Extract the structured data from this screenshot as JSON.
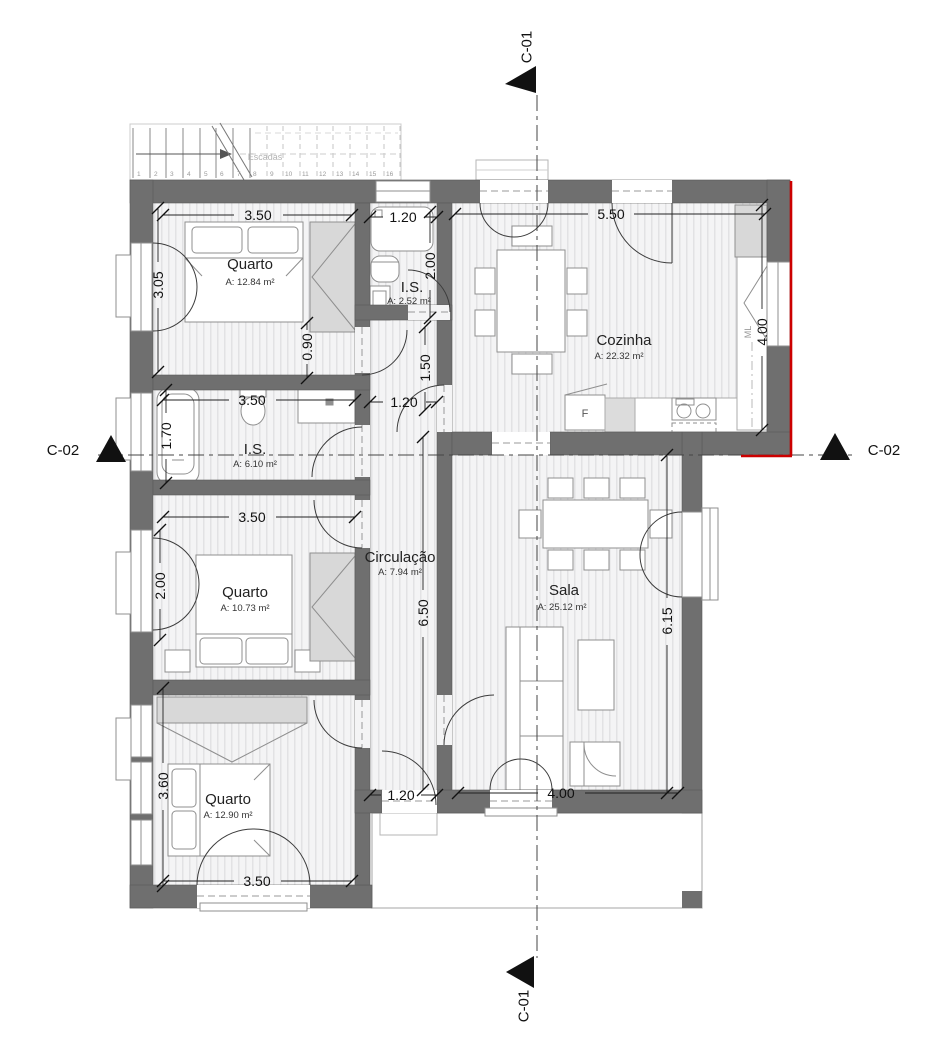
{
  "rooms": {
    "quarto1": {
      "name": "Quarto",
      "area": "A: 12.84 m²"
    },
    "is1": {
      "name": "I.S.",
      "area": "A: 2.52 m²"
    },
    "cozinha": {
      "name": "Cozinha",
      "area": "A: 22.32 m²"
    },
    "is2": {
      "name": "I.S.",
      "area": "A: 6.10 m²"
    },
    "quarto2": {
      "name": "Quarto",
      "area": "A: 10.73 m²"
    },
    "circulacao": {
      "name": "Circulação",
      "area": "A: 7.94 m²"
    },
    "sala": {
      "name": "Sala",
      "area": "A: 25.12 m²"
    },
    "quarto3": {
      "name": "Quarto",
      "area": "A: 12.90 m²"
    }
  },
  "stairs": {
    "label": "Escadas",
    "treads": [
      "1",
      "2",
      "3",
      "4",
      "5",
      "6",
      "7",
      "8",
      "9",
      "10",
      "11",
      "12",
      "13",
      "14",
      "15",
      "16"
    ]
  },
  "dimensions": {
    "quarto1_width": "3.50",
    "is1_width": "1.20",
    "cozinha_width": "5.50",
    "is1_height": "2.00",
    "quarto1_window": "3.05",
    "cozinha_height": "4.00",
    "hall_top": "0.90",
    "hall_door": "1.50",
    "is2_width": "3.50",
    "hall_is2": "1.20",
    "bathtub": "1.70",
    "quarto2_width": "3.50",
    "quarto2_window": "2.00",
    "hall_height": "6.50",
    "sala_height": "6.15",
    "quarto3_window": "3.60",
    "exit_width": "1.20",
    "sala_width": "4.00",
    "quarto3_width": "3.50"
  },
  "appliances": {
    "fridge": "F",
    "washing_machine": "ML"
  },
  "section_markers": {
    "c01": "C-01",
    "c02": "C-02"
  },
  "colors": {
    "wall": "#6f6f6f",
    "section_red": "#cc0000",
    "floor": "#f4f4f5",
    "floor_stripe": "#e2e2e4"
  }
}
